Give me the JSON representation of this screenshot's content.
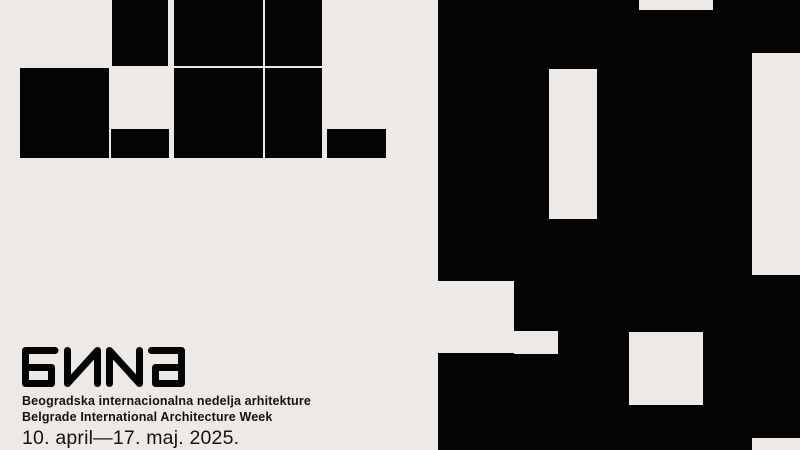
{
  "poster": {
    "logo_text": "БИNа",
    "tagline_sr": "Beogradska internacionalna nedelja arhitekture",
    "tagline_en": "Belgrade International Architecture Week",
    "date_range": "10. april—17. maj. 2025."
  },
  "colors": {
    "background": "#EDE9E6",
    "ink": "#050505"
  },
  "artwork": {
    "left_blocks": [
      {
        "x": 112,
        "y": 0,
        "w": 56,
        "h": 66
      },
      {
        "x": 174,
        "y": 0,
        "w": 89,
        "h": 66
      },
      {
        "x": 265,
        "y": 0,
        "w": 57,
        "h": 66
      },
      {
        "x": 20,
        "y": 68,
        "w": 89,
        "h": 90
      },
      {
        "x": 111,
        "y": 129,
        "w": 58,
        "h": 29
      },
      {
        "x": 174,
        "y": 68,
        "w": 89,
        "h": 90
      },
      {
        "x": 265,
        "y": 68,
        "w": 57,
        "h": 90
      },
      {
        "x": 327,
        "y": 129,
        "w": 59,
        "h": 29
      }
    ],
    "right_field": {
      "x": 438,
      "y": 0,
      "w": 362,
      "h": 450
    },
    "right_cutouts": [
      {
        "x": 639,
        "y": 0,
        "w": 74,
        "h": 10
      },
      {
        "x": 549,
        "y": 69,
        "w": 48,
        "h": 150
      },
      {
        "x": 752,
        "y": 53,
        "w": 48,
        "h": 222
      },
      {
        "x": 438,
        "y": 281,
        "w": 76,
        "h": 72
      },
      {
        "x": 514,
        "y": 331,
        "w": 44,
        "h": 23
      },
      {
        "x": 629,
        "y": 332,
        "w": 74,
        "h": 73
      },
      {
        "x": 752,
        "y": 438,
        "w": 48,
        "h": 12
      }
    ]
  }
}
